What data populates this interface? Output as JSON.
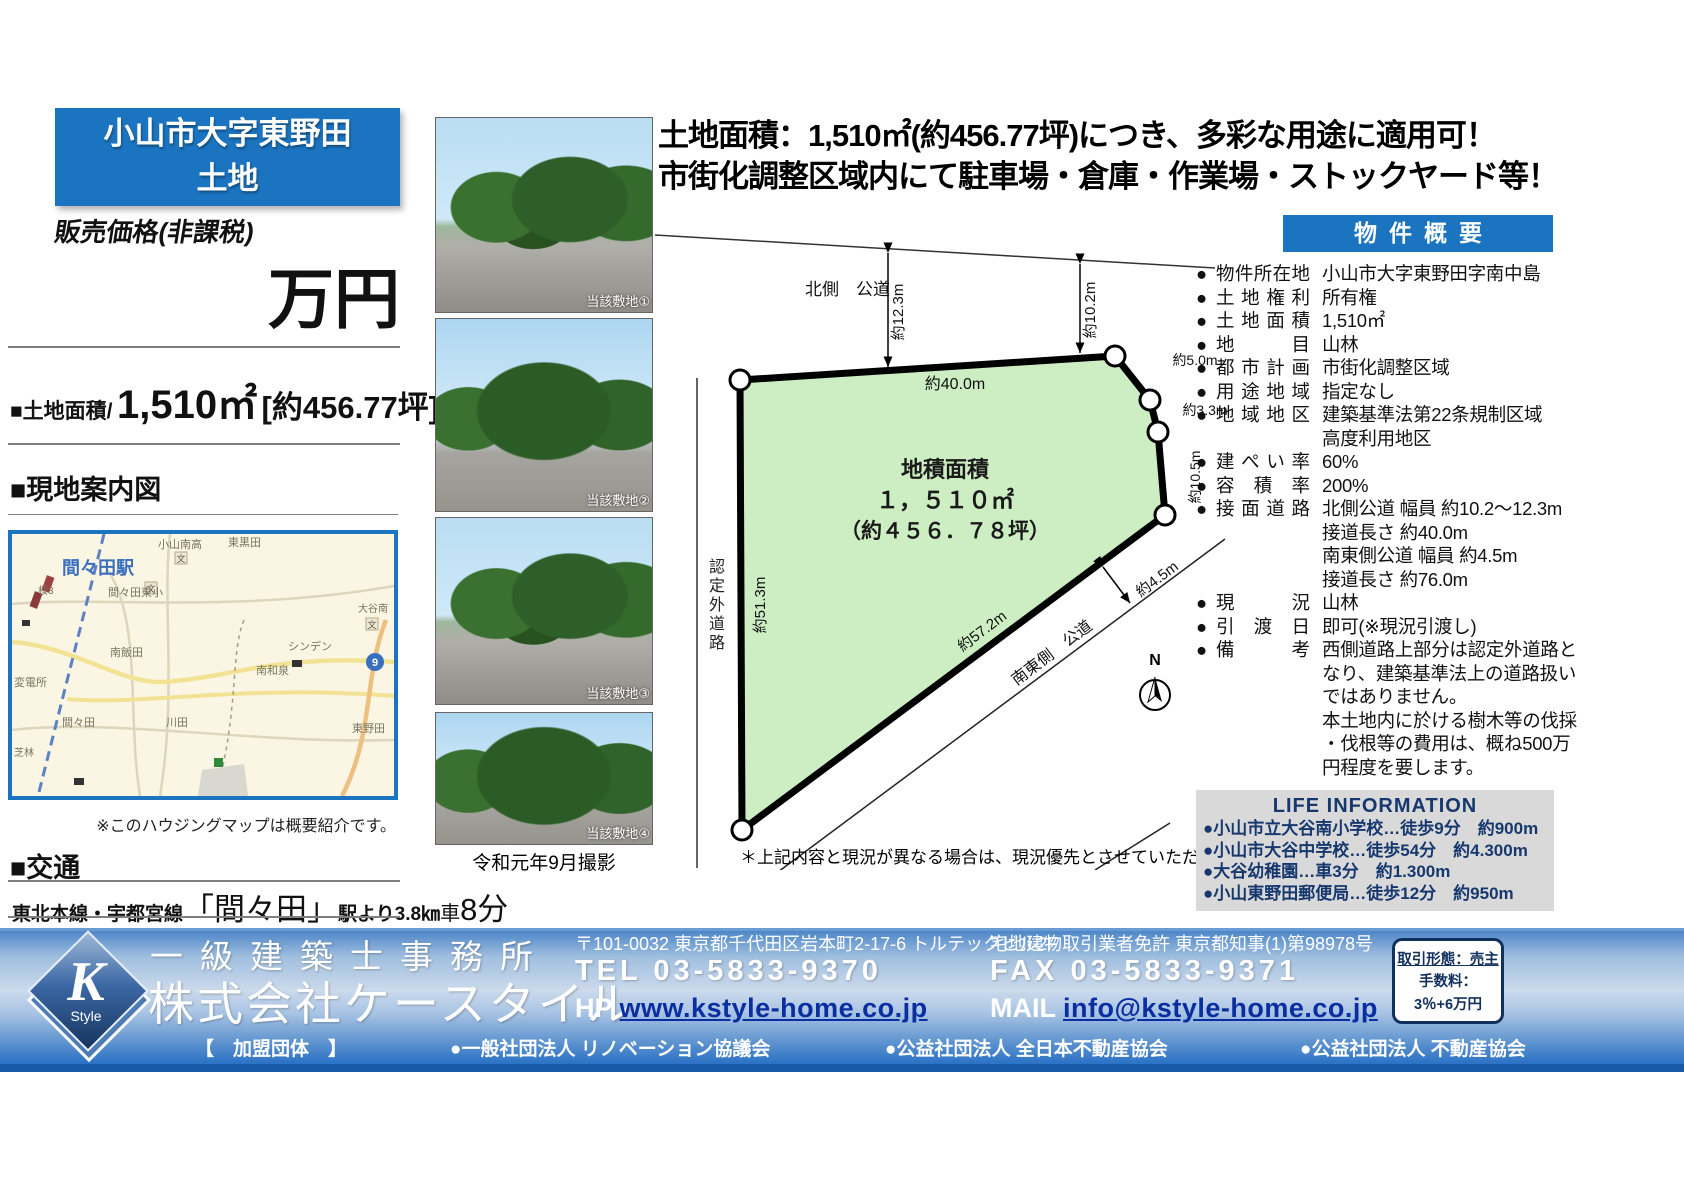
{
  "header": {
    "title_line1": "小山市大字東野田",
    "title_line2": "土地",
    "price_label": "販売価格(非課税)",
    "price_unit": "万円",
    "area_prefix": "■土地面積/",
    "area_value": "1,510㎡",
    "area_tsubo": "[約456.77坪]"
  },
  "headline": {
    "line1": "土地面積：1,510㎡(約456.77坪)につき、多彩な用途に適用可！",
    "line2": "市街化調整区域内にて駐車場・倉庫・作業場・ストックヤード等！"
  },
  "map_section": {
    "heading": "■現地案内図",
    "note": "※このハウジングマップは概要紹介です。",
    "station": "間々田駅",
    "school_icon": "文",
    "route_badge": "9",
    "labels": [
      "小山南高",
      "東黒田",
      "間々田東小",
      "南飯田",
      "シンデン",
      "南和泉",
      "川田",
      "間々田",
      "変電所",
      "東野田",
      "桜3",
      "芝林",
      "大谷南"
    ]
  },
  "transit": {
    "heading": "■交通",
    "line_name": "東北本線・宇都宮線",
    "station": "「間々田」",
    "from_station": "駅より3.8㎞",
    "by_car_prefix": "車",
    "by_car_value": "8分"
  },
  "photos": {
    "captions": [
      "当該敷地①",
      "当該敷地②",
      "当該敷地③",
      "当該敷地④"
    ],
    "date_note": "令和元年9月撮影"
  },
  "diagram": {
    "north_road": "北側　公道",
    "dim_north_west": "約12.3m",
    "dim_north_east": "約10.2m",
    "dim_top": "約40.0m",
    "dim_ne1": "約5.0m",
    "dim_ne2": "約3.3m",
    "dim_east": "約10.5m",
    "dim_west": "約51.3m",
    "west_road": "認定外道路",
    "dim_diag": "約57.2m",
    "se_road": "南東側　公道",
    "dim_se_width": "約4.5m",
    "area_label": "地積面積",
    "area_value": "１，５１０㎡",
    "area_tsubo": "（約４５６．７８坪）",
    "compass": "N",
    "disclaimer": "＊上記内容と現況が異なる場合は、現況優先とさせていただきます。"
  },
  "summary": {
    "header": "物件概要",
    "bullet": "●",
    "rows": [
      {
        "label": "物件所在地",
        "value": "小山市大字東野田字南中島"
      },
      {
        "label": "土地権利",
        "value": "所有権"
      },
      {
        "label": "土地面積",
        "value": "1,510㎡"
      },
      {
        "label": "地目",
        "value": "山林"
      },
      {
        "label": "都市計画",
        "value": "市街化調整区域"
      },
      {
        "label": "用途地域",
        "value": "指定なし"
      },
      {
        "label": "地域地区",
        "value": "建築基準法第22条規制区域\n高度利用地区"
      },
      {
        "label": "建ぺい率",
        "value": "60%"
      },
      {
        "label": "容積率",
        "value": "200%"
      },
      {
        "label": "接面道路",
        "value": "北側公道 幅員 約10.2〜12.3m\n接道長さ 約40.0m\n南東側公道 幅員 約4.5m\n接道長さ 約76.0m"
      },
      {
        "label": "現況",
        "value": "山林"
      },
      {
        "label": "引渡日",
        "value": "即可(※現況引渡し)"
      },
      {
        "label": "備考",
        "value": "西側道路上部分は認定外道路と\nなり、建築基準法上の道路扱い\nではありません。\n本土地内に於ける樹木等の伐採\n・伐根等の費用は、概ね500万\n円程度を要します。"
      }
    ]
  },
  "life_info": {
    "title": "LIFE INFORMATION",
    "items": [
      "●小山市立大谷南小学校…徒歩9分　約900m",
      "●小山市大谷中学校…徒歩54分　約4.300m",
      "●大谷幼稚園…車3分　約1.300m",
      "●小山東野田郵便局…徒歩12分　約950m"
    ]
  },
  "footer": {
    "logo_letter": "K",
    "logo_sub": "Style",
    "office_type": "一級建築士事務所",
    "company": "株式会社ケースタイル",
    "address": "〒101-0032 東京都千代田区岩本町2-17-6 トルテックビル2F",
    "license": "宅地建物取引業者免許 東京都知事(1)第98978号",
    "tel_label": "TEL",
    "tel": "03-5833-9370",
    "fax_label": "FAX",
    "fax": "03-5833-9371",
    "hp_label": "HP",
    "hp": "www.kstyle-home.co.jp",
    "mail_label": "MAIL",
    "mail": "info@kstyle-home.co.jp",
    "deal_type": "取引形態：売主",
    "fee_label": "手数料：",
    "fee_value": "3％+6万円",
    "membership_label": "【　加盟団体　】",
    "memberships": [
      "●一般社団法人 リノベーション協議会",
      "●公益社団法人 全日本不動産協会",
      "●公益社団法人 不動産協会"
    ]
  }
}
